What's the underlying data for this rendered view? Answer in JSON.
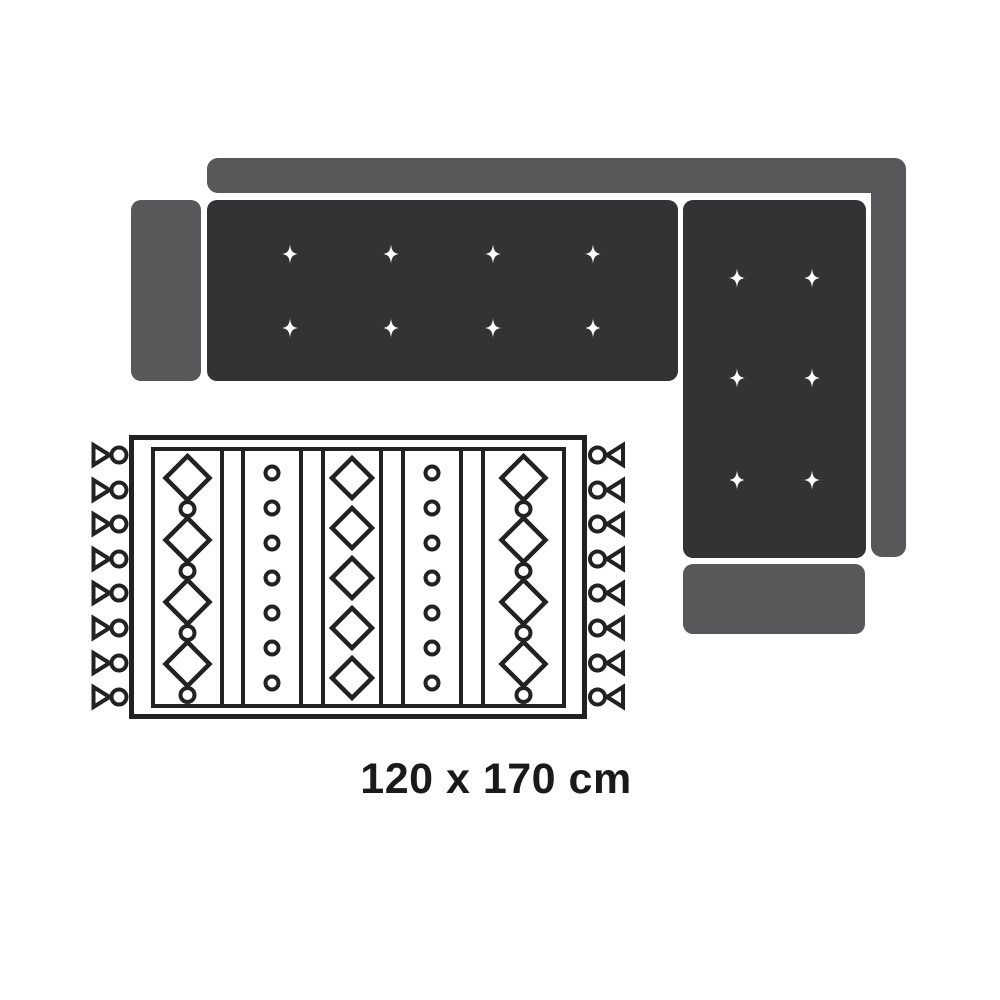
{
  "title": "Sectional sofa with rug size diagram",
  "label": {
    "text": "120 x 170 cm"
  },
  "colors": {
    "background": "#ffffff",
    "sofa_seat": "#333335",
    "sofa_frame": "#58585a",
    "sparkle": "#ffffff",
    "rug_outline": "#222222",
    "rug_fill": "#ffffff",
    "label_text": "#1a1a1a"
  },
  "sofa": {
    "type": "l-shaped-sectional",
    "main_seat": {
      "tuft_columns": 4,
      "tuft_rows": 2
    },
    "chaise": {
      "tuft_columns": 2,
      "tuft_rows": 3
    }
  },
  "rug": {
    "type": "patterned-area-rug",
    "fringe_sides": [
      "left",
      "right"
    ],
    "fringe_tassels_per_side": 8,
    "pattern_columns": [
      {
        "type": "diamond-circle",
        "diamonds": 4,
        "circles": 4
      },
      {
        "type": "circles",
        "circles": 7
      },
      {
        "type": "diamonds",
        "diamonds": 5
      },
      {
        "type": "circles",
        "circles": 7
      },
      {
        "type": "diamond-circle",
        "diamonds": 4,
        "circles": 4
      }
    ]
  }
}
